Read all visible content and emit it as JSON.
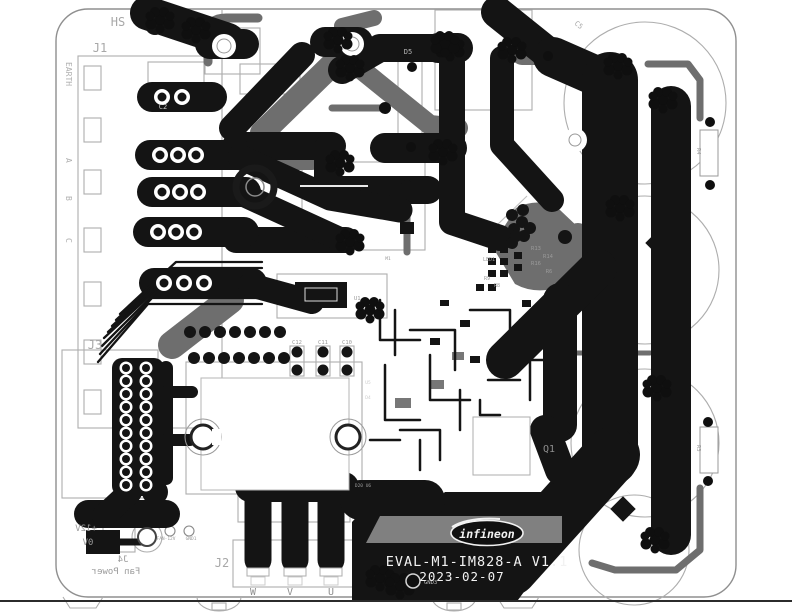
{
  "board_text": {
    "model": "EVAL-M1-IM828-A V1.1",
    "date": "2023-02-07",
    "logo": "infineon"
  },
  "refs": {
    "hs": "HS",
    "j1": "J1",
    "j2": "J2",
    "j3": "J3",
    "j4": "J4",
    "fan_power": "Fan Power",
    "plus12v": "+12V",
    "zero_v": "0V",
    "earth": "EARTH",
    "phase_a": "A",
    "phase_b": "B",
    "phase_c": "C",
    "phase_w": "W",
    "phase_v": "V",
    "phase_u": "U",
    "fan12v": "FAN-12V",
    "gnd1": "GND1",
    "gnd3": "GND3",
    "c2": "C2",
    "c5": "C5",
    "d5": "D5",
    "q1": "Q1",
    "r3": "R3",
    "r4": "R4",
    "r6": "R6",
    "r8": "R8",
    "r9": "R9",
    "r13": "R13",
    "r14": "R14",
    "r16": "R16",
    "c10": "C10",
    "c11": "C11",
    "c12": "C12",
    "u1": "U1",
    "u5": "U5",
    "d4": "D4",
    "m1": "M1",
    "d20u6": "D20 U6",
    "led1": "LED1"
  },
  "colors": {
    "copper_top": "#141414",
    "copper_bottom": "#6e6e6e",
    "silkscreen": "#adadad",
    "board_outline": "#8f8f8f",
    "text_light": "#f2f2f2"
  }
}
